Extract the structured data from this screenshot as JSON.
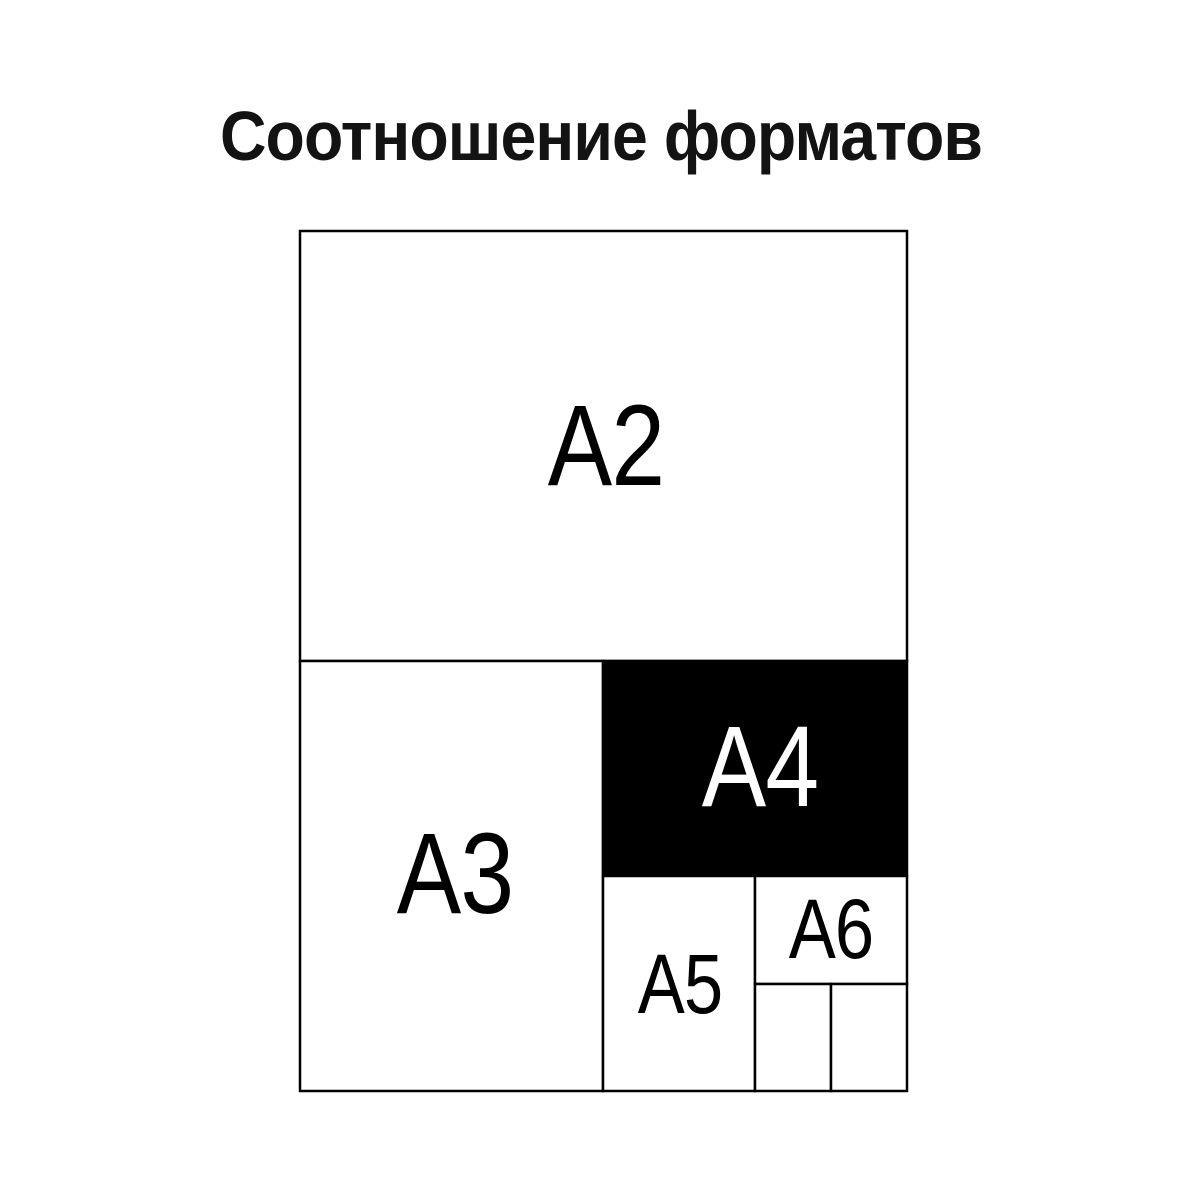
{
  "page": {
    "background_color": "#ffffff"
  },
  "title": {
    "text": "Соотношение форматов",
    "color": "#131313"
  },
  "diagram": {
    "description_semantic": "nested paper format size comparison",
    "line_color": "#000000",
    "highlight_fill": "#000000",
    "highlight_label_color": "#ffffff",
    "labels": {
      "a2": "А2",
      "a3": "А3",
      "a4": "А4",
      "a5": "А5",
      "a6": "А6"
    }
  }
}
